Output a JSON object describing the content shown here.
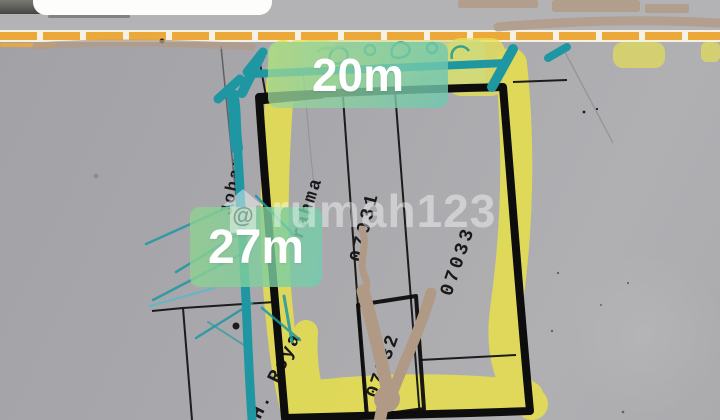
{
  "dimension_labels": {
    "width": "20m",
    "depth": "27m"
  },
  "streets": {
    "left": "Johar",
    "inner": "rahma",
    "bottom": "H. Roya"
  },
  "parcels": {
    "left": "07031",
    "bottom": "07032",
    "right": "07033"
  },
  "watermark": {
    "at_symbol": "@",
    "brand": "rumah123"
  },
  "colors": {
    "highlighter_yellow": "#e8e04b",
    "marker_teal": "#1f97a3",
    "label_green": "#8fcfa9",
    "plot_outline": "#0d0d0d",
    "paper_gray": "#a7a7ab",
    "road_dash_orange": "#eca93a",
    "tree_tan": "#b19a85"
  }
}
